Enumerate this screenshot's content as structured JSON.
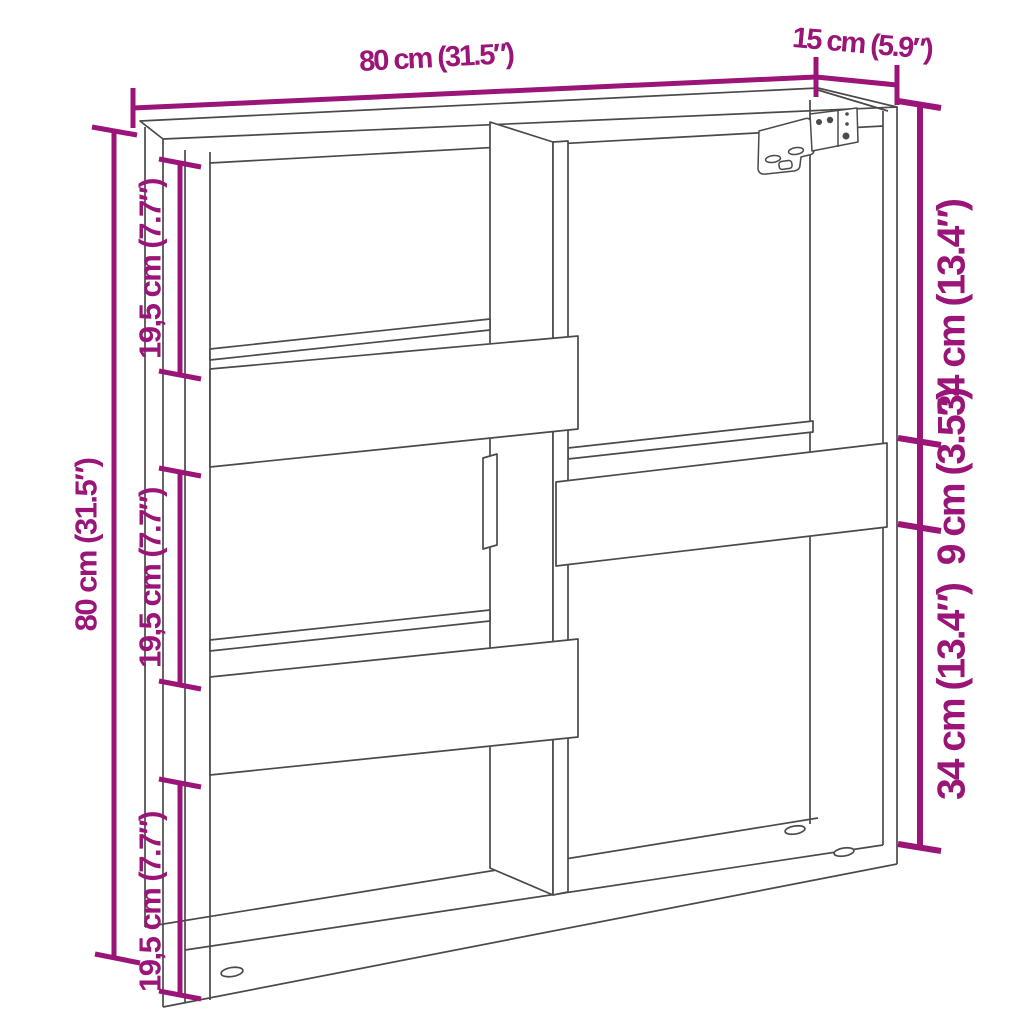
{
  "diagram": {
    "type": "product-dimension-diagram",
    "subject": "wall cabinet line drawing with offset shelves and center divider",
    "colors": {
      "dimension": "#9B1478",
      "line": "#4A4A4A",
      "background": "#FFFFFF"
    },
    "dimensions": {
      "top_width": "80 cm (31.5″)",
      "top_depth": "15 cm (5.9″)",
      "left_height": "80 cm (31.5″)",
      "left_inner": [
        "19,5 cm (7.7″)",
        "19,5 cm (7.7″)",
        "19,5 cm (7.7″)"
      ],
      "right": [
        "34 cm (13.4″)",
        "9 cm (3.5″)",
        "34 cm (13.4″)"
      ]
    }
  }
}
